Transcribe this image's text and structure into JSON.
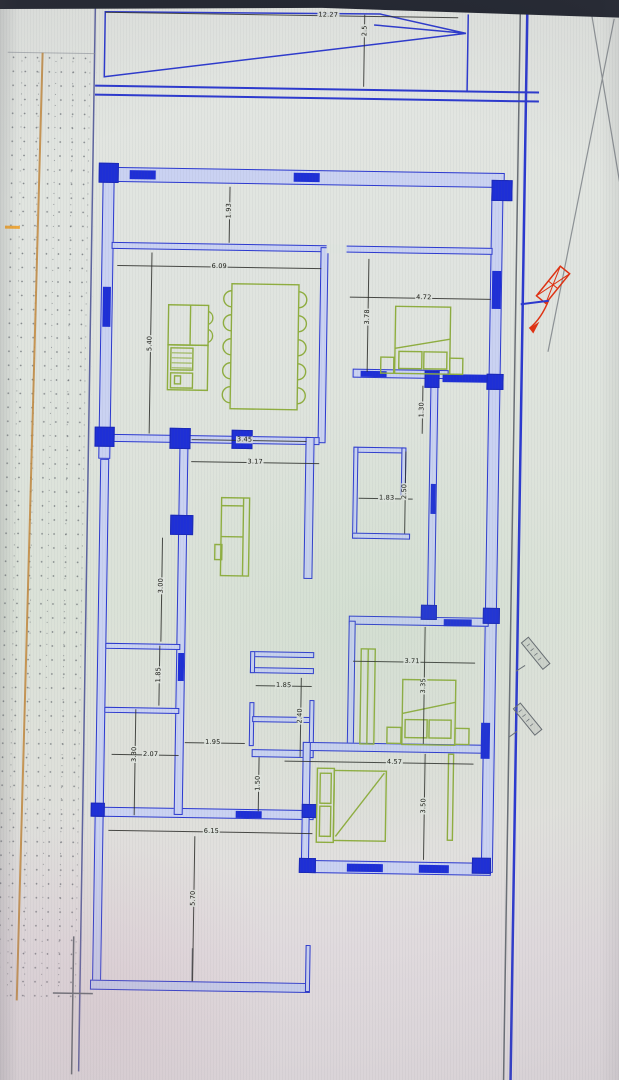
{
  "scene": {
    "description": "photographed CAD architectural floor plan on a screen",
    "bezel_color": "#21252f",
    "paper_color": "#dfe4df"
  },
  "palette": {
    "wall_stroke": "#2c39cf",
    "wall_fill": "#cad2f2",
    "wall_solid": "#1e2fd6",
    "furniture_green": "#8fae3f",
    "dimension_black": "#2a2c28",
    "site_tan_line": "#c1873c",
    "marker_red": "#e03212",
    "parcel_gray": "#6a6f76"
  },
  "dimensions": [
    {
      "id": "lot-width",
      "value": "12.27",
      "label_x": 320,
      "label_y": 15,
      "vertical": false,
      "line": [
        97,
        15,
        450,
        15
      ]
    },
    {
      "id": "ramp-offset",
      "value": "2.5",
      "label_x": 357,
      "label_y": 30,
      "vertical": true,
      "line": [
        356,
        14,
        356,
        86
      ]
    },
    {
      "id": "veranda-depth",
      "value": "1.93",
      "label_x": 224,
      "label_y": 212,
      "vertical": true,
      "line": [
        224,
        188,
        224,
        244
      ]
    },
    {
      "id": "dining-width",
      "value": "6.09",
      "label_x": 215,
      "label_y": 268,
      "vertical": false,
      "line": [
        113,
        268,
        317,
        268
      ]
    },
    {
      "id": "dining-depth",
      "value": "5.40",
      "label_x": 147,
      "label_y": 346,
      "vertical": true,
      "line": [
        147,
        255,
        147,
        436
      ]
    },
    {
      "id": "ne-bedroom-width",
      "value": "4.72",
      "label_x": 420,
      "label_y": 296,
      "vertical": false,
      "line": [
        346,
        296,
        487,
        296
      ]
    },
    {
      "id": "ne-bedroom-depth",
      "value": "3.78",
      "label_x": 364,
      "label_y": 316,
      "vertical": true,
      "line": [
        364,
        258,
        364,
        371
      ]
    },
    {
      "id": "corridor-width",
      "value": "1.30",
      "label_x": 420,
      "label_y": 408,
      "vertical": true,
      "line": [
        420,
        384,
        420,
        432
      ]
    },
    {
      "id": "living-width-1",
      "value": "3.45",
      "label_x": 243,
      "label_y": 441,
      "vertical": false,
      "line": [
        190,
        441,
        305,
        441
      ]
    },
    {
      "id": "living-width-2",
      "value": "3.17",
      "label_x": 254,
      "label_y": 463,
      "vertical": false,
      "line": [
        190,
        463,
        318,
        463
      ]
    },
    {
      "id": "bath-width",
      "value": "1.83",
      "label_x": 386,
      "label_y": 497,
      "vertical": false,
      "line": [
        358,
        497,
        412,
        497
      ]
    },
    {
      "id": "bath-depth",
      "value": "2.50",
      "label_x": 404,
      "label_y": 490,
      "vertical": true,
      "line": [
        404,
        450,
        404,
        532
      ]
    },
    {
      "id": "left-room-1-depth",
      "value": "3.00",
      "label_x": 162,
      "label_y": 588,
      "vertical": true,
      "line": [
        162,
        540,
        162,
        644
      ]
    },
    {
      "id": "left-room-2-depth",
      "value": "1.85",
      "label_x": 161,
      "label_y": 677,
      "vertical": true,
      "line": [
        161,
        648,
        161,
        708
      ]
    },
    {
      "id": "left-room-3-depth",
      "value": "3.30",
      "label_x": 138,
      "label_y": 757,
      "vertical": true,
      "line": [
        138,
        712,
        138,
        818
      ]
    },
    {
      "id": "left-room-3-width",
      "value": "2.07",
      "label_x": 154,
      "label_y": 757,
      "vertical": false,
      "line": [
        115,
        757,
        182,
        757
      ]
    },
    {
      "id": "hall-width",
      "value": "1.95",
      "label_x": 216,
      "label_y": 744,
      "vertical": false,
      "line": [
        188,
        744,
        248,
        744
      ]
    },
    {
      "id": "closet-width",
      "value": "1.85",
      "label_x": 286,
      "label_y": 686,
      "vertical": false,
      "line": [
        258,
        686,
        314,
        686
      ]
    },
    {
      "id": "closet-depth",
      "value": "2.40",
      "label_x": 303,
      "label_y": 716,
      "vertical": true,
      "line": [
        303,
        678,
        303,
        757
      ]
    },
    {
      "id": "hall-depth",
      "value": "1.50",
      "label_x": 262,
      "label_y": 784,
      "vertical": true,
      "line": [
        262,
        758,
        262,
        812
      ]
    },
    {
      "id": "se-bedroom-width",
      "value": "3.71",
      "label_x": 414,
      "label_y": 660,
      "vertical": false,
      "line": [
        355,
        660,
        477,
        660
      ]
    },
    {
      "id": "se-bedroom-depth",
      "value": "3.35",
      "label_x": 426,
      "label_y": 684,
      "vertical": true,
      "line": [
        426,
        625,
        426,
        742
      ]
    },
    {
      "id": "s-bedroom-width",
      "value": "4.57",
      "label_x": 398,
      "label_y": 761,
      "vertical": false,
      "line": [
        288,
        761,
        477,
        761
      ]
    },
    {
      "id": "s-bedroom-depth",
      "value": "3.50",
      "label_x": 428,
      "label_y": 804,
      "vertical": true,
      "line": [
        428,
        752,
        428,
        858
      ]
    },
    {
      "id": "patio-width",
      "value": "6.15",
      "label_x": 216,
      "label_y": 833,
      "vertical": false,
      "line": [
        113,
        833,
        317,
        833
      ]
    },
    {
      "id": "patio-depth",
      "value": "5.70",
      "label_x": 199,
      "label_y": 900,
      "vertical": true,
      "line": [
        199,
        838,
        199,
        983
      ]
    }
  ],
  "plan_geometry": {
    "walls": [
      [
        97,
        170,
        402,
        15,
        "top-exterior-wall"
      ],
      [
        97,
        170,
        12,
        292,
        "left-exterior-wall-upper"
      ],
      [
        99,
        462,
        9,
        530,
        "left-exterior-wall-lower"
      ],
      [
        486,
        182,
        12,
        688,
        "right-exterior-wall"
      ],
      [
        97,
        983,
        220,
        10,
        "patio-bottom-wall"
      ],
      [
        97,
        810,
        221,
        10,
        "patio-top-wall"
      ],
      [
        306,
        860,
        190,
        13,
        "south-bedroom-bottom-wall"
      ],
      [
        107,
        245,
        381,
        7,
        "veranda-interior-wall"
      ],
      [
        316,
        247,
        8,
        196,
        "dining-partition-wall"
      ],
      [
        107,
        437,
        211,
        8,
        "living-north-wall"
      ],
      [
        178,
        445,
        9,
        372,
        "left-rooms-east-wall"
      ],
      [
        107,
        646,
        75,
        6,
        "left-room-divider-wall-1"
      ],
      [
        107,
        710,
        75,
        6,
        "left-room-divider-wall-2"
      ],
      [
        350,
        368,
        96,
        9,
        "ne-bedroom-south-wall"
      ],
      [
        428,
        384,
        8,
        234,
        "corridor-east-wall"
      ],
      [
        352,
        446,
        52,
        6,
        "bathroom-north-wall"
      ],
      [
        352,
        446,
        5,
        92,
        "bathroom-west-wall"
      ],
      [
        352,
        532,
        58,
        6,
        "bathroom-south-wall"
      ],
      [
        400,
        446,
        5,
        48,
        "bathroom-east-wall"
      ],
      [
        304,
        437,
        9,
        142,
        "living-east-wall"
      ],
      [
        252,
        652,
        64,
        6,
        "hall-closet-wall-1"
      ],
      [
        252,
        668,
        64,
        6,
        "hall-closet-wall-2"
      ],
      [
        252,
        652,
        5,
        22,
        "hall-closet-cap"
      ],
      [
        252,
        703,
        5,
        44,
        "hall-west-stub-wall"
      ],
      [
        255,
        717,
        58,
        6,
        "hall-closet-wall-3"
      ],
      [
        255,
        750,
        62,
        8,
        "hall-closet-wall-4"
      ],
      [
        312,
        700,
        5,
        58,
        "hall-east-stub-wall"
      ],
      [
        350,
        615,
        140,
        9,
        "se-bedroom-north-wall"
      ],
      [
        350,
        620,
        7,
        125,
        "se-bedroom-west-wall"
      ],
      [
        306,
        742,
        182,
        9,
        "bedrooms-divider-wall"
      ],
      [
        306,
        742,
        8,
        125,
        "south-bedroom-west-wall"
      ],
      [
        312,
        945,
        5,
        47,
        "patio-inner-wall-stub"
      ]
    ],
    "windows": [
      [
        124,
        173,
        26,
        9,
        "window-top-1"
      ],
      [
        288,
        173,
        26,
        9,
        "window-top-2"
      ],
      [
        99,
        290,
        8,
        40,
        "window-left-1"
      ],
      [
        488,
        268,
        9,
        38,
        "window-right-1"
      ],
      [
        484,
        720,
        9,
        36,
        "window-right-2"
      ],
      [
        352,
        863,
        36,
        8,
        "window-south-1"
      ],
      [
        424,
        863,
        30,
        8,
        "window-south-2"
      ],
      [
        240,
        812,
        26,
        7,
        "window-patio-1"
      ],
      [
        180,
        655,
        6,
        28,
        "window-left-rooms-1"
      ],
      [
        430,
        482,
        5,
        30,
        "window-corridor-1"
      ],
      [
        358,
        370,
        26,
        6,
        "wardrobe-niche-dark"
      ],
      [
        440,
        372,
        44,
        8,
        "beam-dark-1"
      ],
      [
        445,
        617,
        28,
        7,
        "beam-dark-2"
      ]
    ],
    "columns": [
      [
        93,
        166,
        20,
        20,
        "column-nw"
      ],
      [
        486,
        177,
        21,
        21,
        "column-ne"
      ],
      [
        93,
        430,
        20,
        20,
        "column-left-mid"
      ],
      [
        168,
        430,
        21,
        21,
        "column-interior-1"
      ],
      [
        230,
        431,
        21,
        19,
        "column-interior-2"
      ],
      [
        170,
        517,
        23,
        20,
        "column-interior-3"
      ],
      [
        422,
        369,
        15,
        17,
        "column-corridor-n"
      ],
      [
        484,
        371,
        17,
        16,
        "column-right-mid-1"
      ],
      [
        422,
        603,
        16,
        15,
        "column-corridor-s"
      ],
      [
        484,
        605,
        17,
        16,
        "column-right-mid-2"
      ],
      [
        306,
        804,
        15,
        14,
        "column-hall-s"
      ],
      [
        304,
        858,
        17,
        15,
        "column-sw-bedroom"
      ],
      [
        477,
        855,
        19,
        16,
        "column-se-bedroom"
      ],
      [
        95,
        806,
        14,
        14,
        "column-patio-nw"
      ]
    ],
    "gaps": [
      [
        322,
        244,
        20,
        9,
        "door-opening-veranda"
      ]
    ]
  }
}
